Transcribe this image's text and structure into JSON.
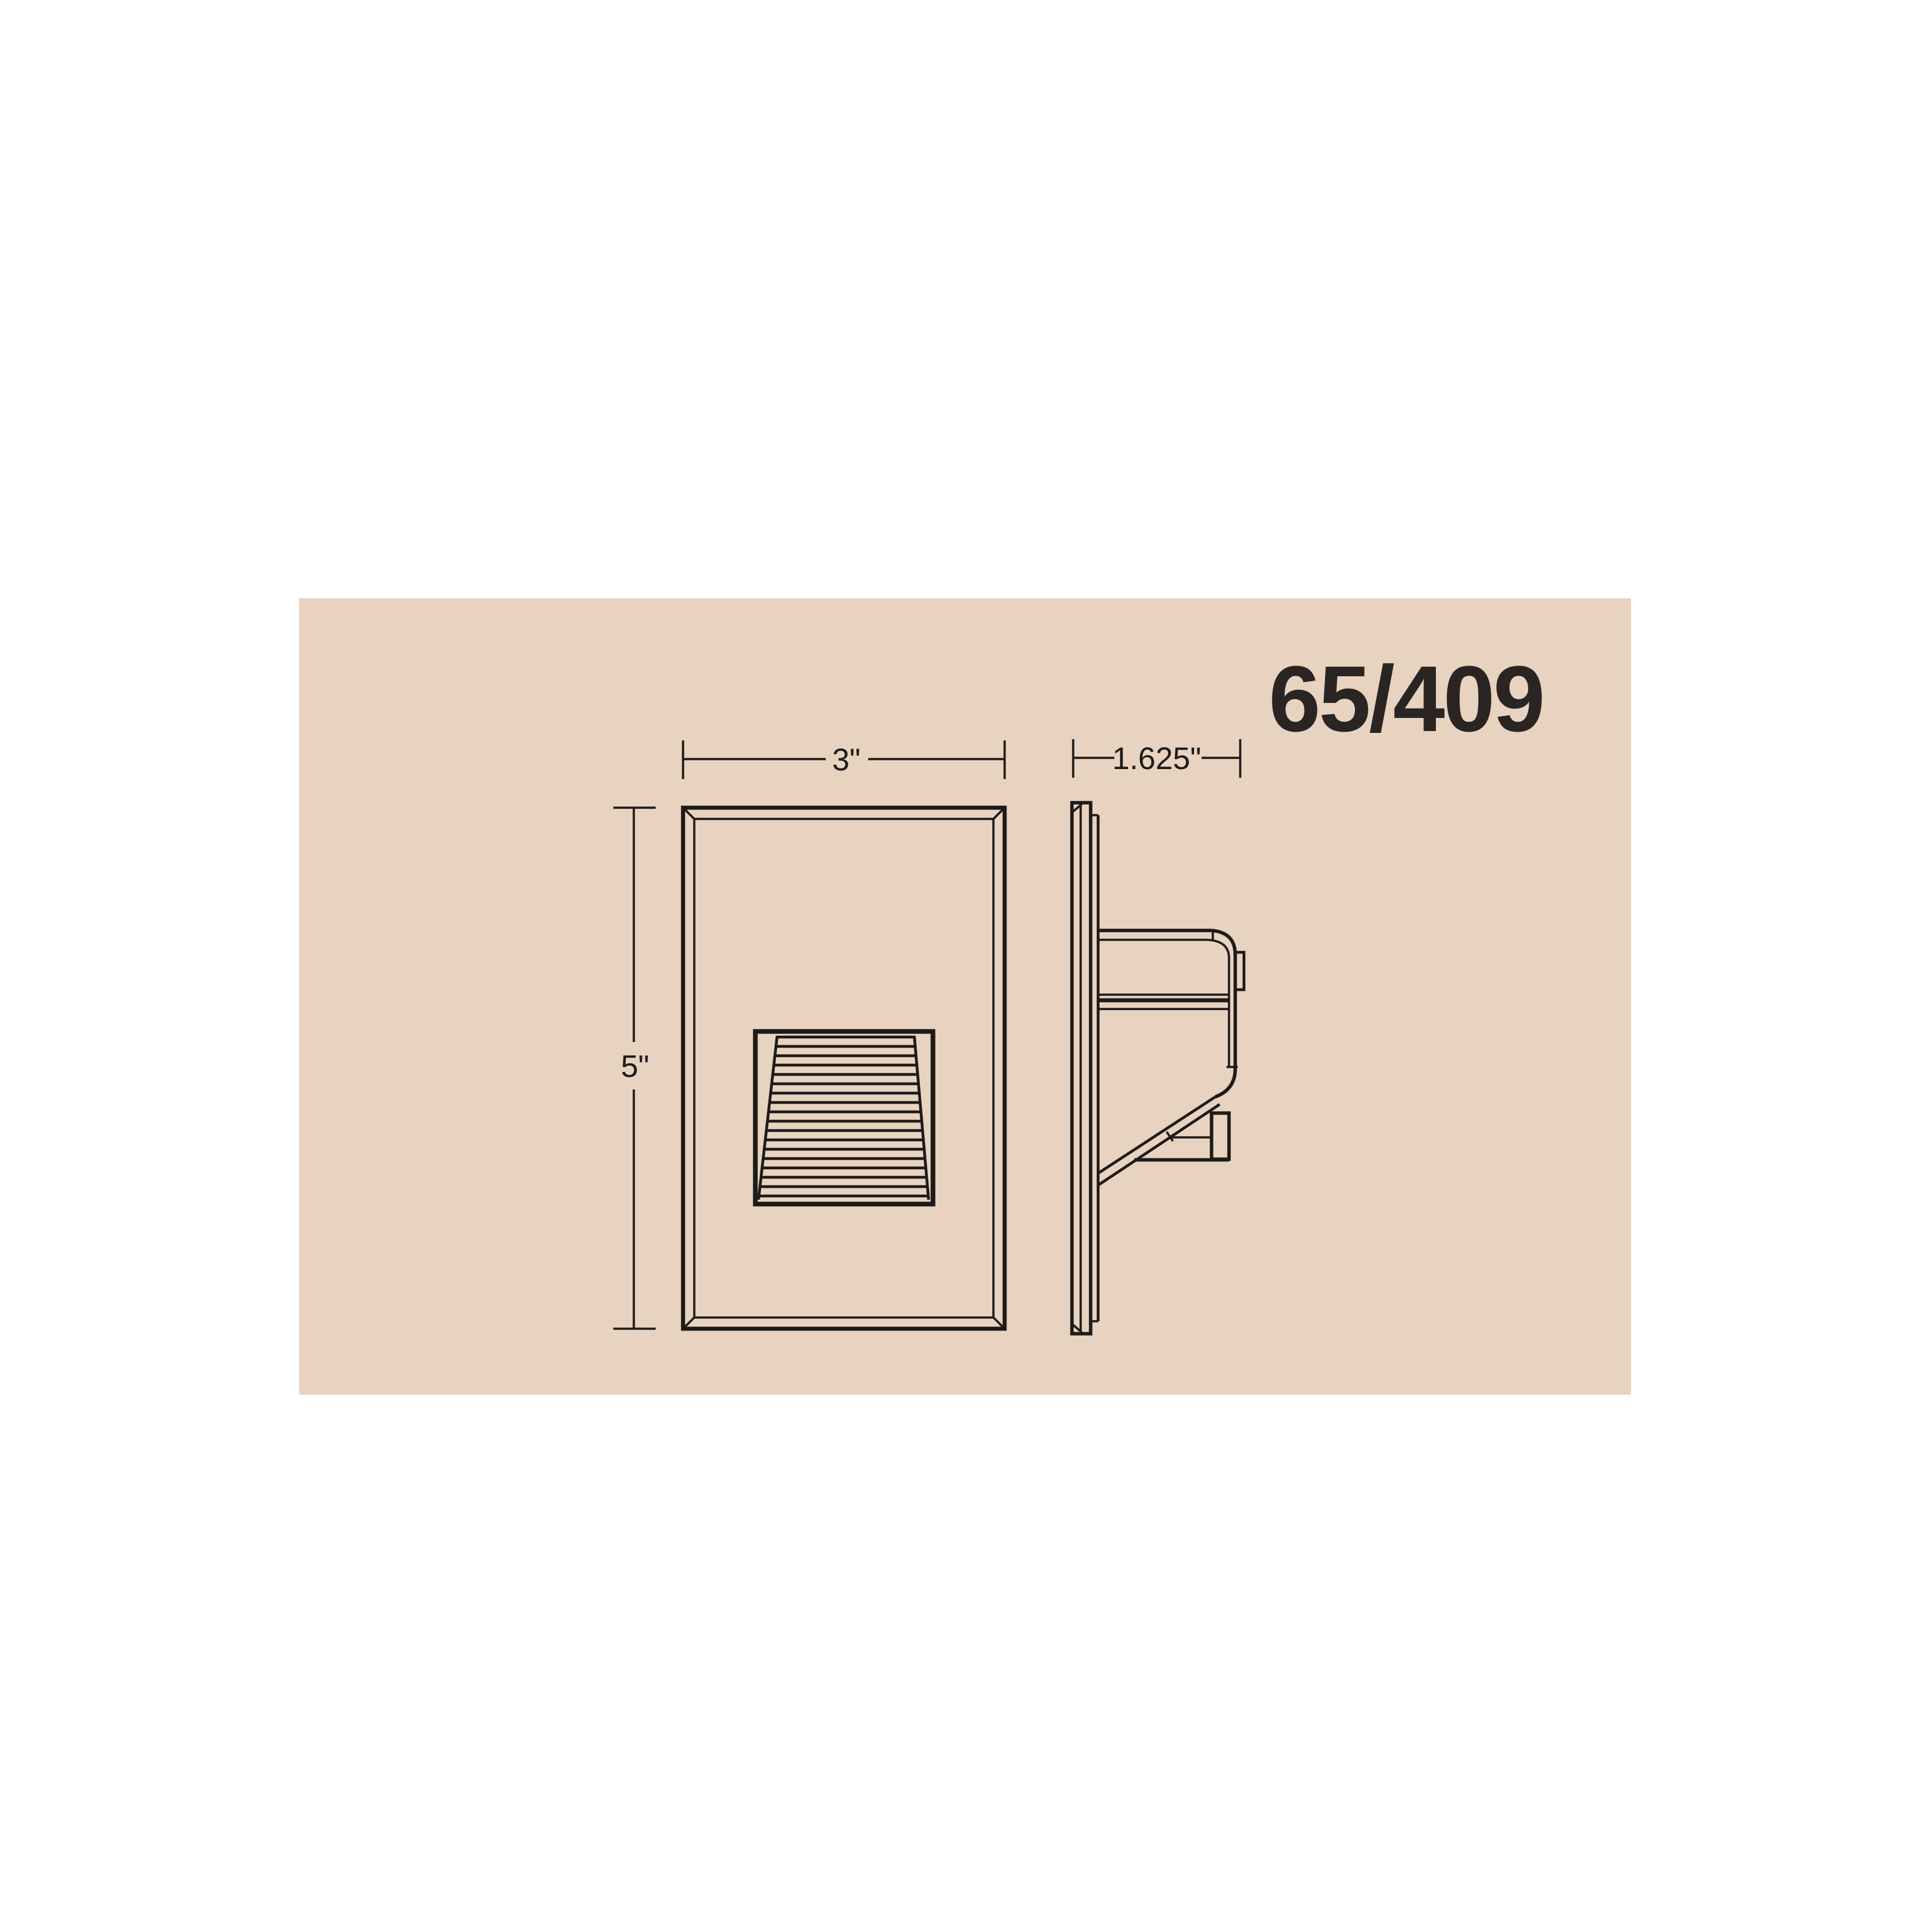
{
  "colors": {
    "page_background": "#ffffff",
    "canvas_background": "#e7d3c0",
    "line_color": "#1e1a18",
    "text_color": "#2a2423"
  },
  "drawing": {
    "product_code": "65/409",
    "front_view": {
      "width_label": "3\"",
      "height_label": "5\""
    },
    "side_view": {
      "depth_label": "1.625\""
    }
  }
}
